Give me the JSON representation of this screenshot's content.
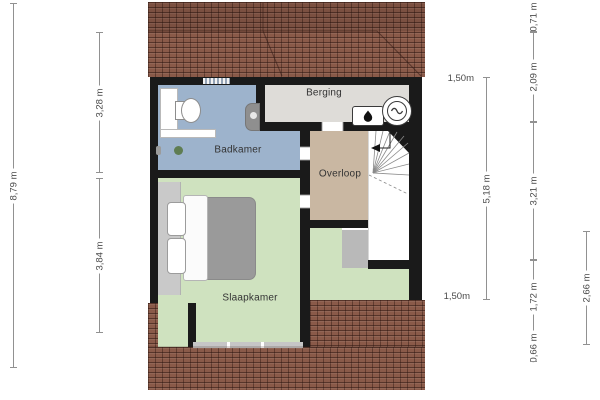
{
  "plan": {
    "type": "floorplan-second-floor",
    "rooms": [
      {
        "id": "badkamer",
        "label": "Badkamer"
      },
      {
        "id": "berging",
        "label": "Berging"
      },
      {
        "id": "overloop",
        "label": "Overloop"
      },
      {
        "id": "slaapkamer",
        "label": "Slaapkamer"
      }
    ],
    "fixtures": [
      "toilet",
      "sink",
      "shower-cabinet",
      "bath-ledge",
      "plant",
      "fireplace",
      "boiler-unit",
      "stairs",
      "bed",
      "wardrobe",
      "dormer-window"
    ],
    "colors": {
      "badkamer": "#9db3cc",
      "berging": "#dedcd8",
      "overloop": "#c9b7a2",
      "slaapkamer": "#cfe2bf",
      "stairwell": "#ffffff",
      "gray_patch": "#b9b9b9",
      "roof": "#8a5a49",
      "wall": "#1a1a1a"
    }
  },
  "dimensions": {
    "left_total": {
      "label": "8,79 m"
    },
    "left_top": {
      "label": "3,28 m"
    },
    "left_bottom": {
      "label": "3,84 m"
    },
    "right_inner": {
      "label": "5,18 m"
    },
    "right_chain": [
      {
        "label": "0,71 m"
      },
      {
        "label": "2,09 m"
      },
      {
        "label": "3,21 m"
      },
      {
        "label": "1,72 m"
      },
      {
        "label": "0,66 m"
      }
    ],
    "right_outer": {
      "label": "2,66 m"
    },
    "headroom_top": {
      "label": "1,50m"
    },
    "headroom_bottom": {
      "label": "1,50m"
    }
  }
}
